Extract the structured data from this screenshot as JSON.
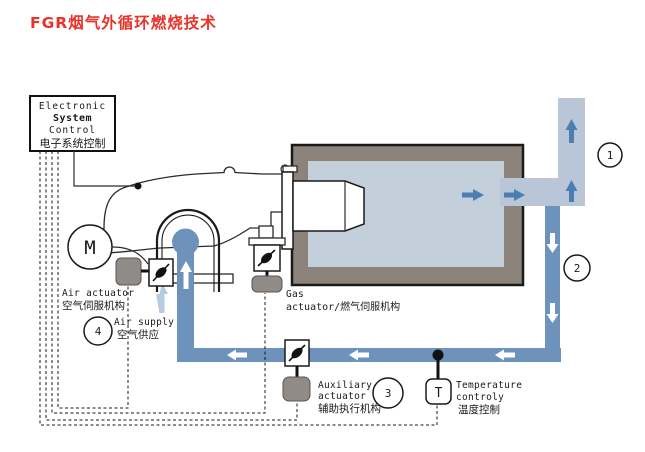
{
  "title": "FGR烟气外循环燃烧技术",
  "colors": {
    "title_red": "#e8332a",
    "duct_light": "#b8c6d8",
    "pipe_dark": "#6d92bc",
    "arrow_blue": "#4c7eb2",
    "air_arrow": "#b5cbe0",
    "furnace_wall": "#8c837a",
    "furnace_interior": "#c4cfdc",
    "actuator_gray": "#908b86"
  },
  "control_box": {
    "line1": "Electronic",
    "line2": "System",
    "line3": "Control",
    "line4": "电子系统控制"
  },
  "labels": {
    "motor": "M",
    "air_actuator_en": "Air actuator",
    "air_actuator_zh": "空气伺服机构",
    "air_supply_en": "Air supply",
    "air_supply_zh": "空气供应",
    "gas_en": "Gas",
    "gas_actuator": "actuator/燃气伺服机构",
    "aux_line1": "Auxiliary",
    "aux_line2": "actuator",
    "aux_zh": "辅助执行机构",
    "temp_sensor": "T",
    "temp_line1": "Temperature",
    "temp_line2": "controly",
    "temp_zh": "温度控制"
  },
  "markers": {
    "m1": "1",
    "m2": "2",
    "m3": "3",
    "m4": "4"
  }
}
